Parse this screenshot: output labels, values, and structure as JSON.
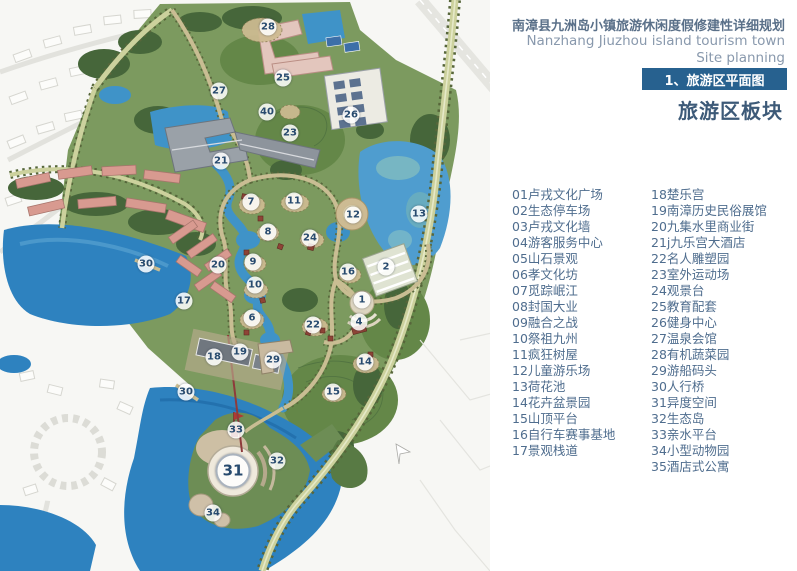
{
  "header": {
    "title_cn": "南漳县九洲岛小镇旅游休闲度假修建性详细规划",
    "title_en_line1": "Nanzhang Jiuzhou island tourism town",
    "title_en_line2": "Site planning",
    "section_banner": "1、旅游区平面图",
    "section_subtitle": "旅游区板块"
  },
  "legend": {
    "col1": [
      {
        "num": "01",
        "label": "卢戎文化广场"
      },
      {
        "num": "02",
        "label": "生态停车场"
      },
      {
        "num": "03",
        "label": "卢戎文化墙"
      },
      {
        "num": "04",
        "label": "游客服务中心"
      },
      {
        "num": "05",
        "label": "山石景观"
      },
      {
        "num": "06",
        "label": "孝文化坊"
      },
      {
        "num": "07",
        "label": "觅踪岷江"
      },
      {
        "num": "08",
        "label": "封国大业"
      },
      {
        "num": "09",
        "label": "融合之战"
      },
      {
        "num": "10",
        "label": "祭祖九州"
      },
      {
        "num": "11",
        "label": "疯狂树屋"
      },
      {
        "num": "12",
        "label": "儿童游乐场"
      },
      {
        "num": "13",
        "label": "荷花池"
      },
      {
        "num": "14",
        "label": "花卉盆景园"
      },
      {
        "num": "15",
        "label": "山顶平台"
      },
      {
        "num": "16",
        "label": "自行车赛事基地"
      },
      {
        "num": "17",
        "label": "景观栈道"
      }
    ],
    "col2": [
      {
        "num": "18",
        "label": "楚乐宫"
      },
      {
        "num": "19",
        "label": "南漳历史民俗展馆"
      },
      {
        "num": "20",
        "label": "九集水里商业街"
      },
      {
        "num": "21",
        "label": "j九乐宫大酒店"
      },
      {
        "num": "22",
        "label": "名人雕塑园"
      },
      {
        "num": "23",
        "label": "室外运动场"
      },
      {
        "num": "24",
        "label": "观景台"
      },
      {
        "num": "25",
        "label": "教育配套"
      },
      {
        "num": "26",
        "label": "健身中心"
      },
      {
        "num": "27",
        "label": "温泉会馆"
      },
      {
        "num": "28",
        "label": "有机蔬菜园"
      },
      {
        "num": "29",
        "label": "游船码头"
      },
      {
        "num": "30",
        "label": "人行桥"
      },
      {
        "num": "31",
        "label": "异度空间"
      },
      {
        "num": "32",
        "label": "生态岛"
      },
      {
        "num": "33",
        "label": "亲水平台"
      },
      {
        "num": "34",
        "label": "小型动物园"
      },
      {
        "num": "35",
        "label": "酒店式公寓"
      }
    ]
  },
  "map": {
    "markers": [
      {
        "n": "28",
        "x": 268,
        "y": 27
      },
      {
        "n": "25",
        "x": 283,
        "y": 78
      },
      {
        "n": "27",
        "x": 219,
        "y": 91
      },
      {
        "n": "40",
        "x": 267,
        "y": 112
      },
      {
        "n": "26",
        "x": 351,
        "y": 115
      },
      {
        "n": "23",
        "x": 290,
        "y": 133
      },
      {
        "n": "21",
        "x": 221,
        "y": 161
      },
      {
        "n": "7",
        "x": 251,
        "y": 202
      },
      {
        "n": "11",
        "x": 294,
        "y": 201
      },
      {
        "n": "12",
        "x": 353,
        "y": 215
      },
      {
        "n": "13",
        "x": 419,
        "y": 214
      },
      {
        "n": "8",
        "x": 268,
        "y": 232
      },
      {
        "n": "24",
        "x": 310,
        "y": 238
      },
      {
        "n": "9",
        "x": 253,
        "y": 262
      },
      {
        "n": "20",
        "x": 218,
        "y": 265
      },
      {
        "n": "30",
        "x": 146,
        "y": 264
      },
      {
        "n": "2",
        "x": 386,
        "y": 267
      },
      {
        "n": "16",
        "x": 348,
        "y": 272
      },
      {
        "n": "10",
        "x": 255,
        "y": 285
      },
      {
        "n": "17",
        "x": 184,
        "y": 301
      },
      {
        "n": "1",
        "x": 362,
        "y": 300
      },
      {
        "n": "6",
        "x": 252,
        "y": 318
      },
      {
        "n": "4",
        "x": 359,
        "y": 322
      },
      {
        "n": "22",
        "x": 313,
        "y": 325
      },
      {
        "n": "19",
        "x": 240,
        "y": 352
      },
      {
        "n": "18",
        "x": 214,
        "y": 357
      },
      {
        "n": "29",
        "x": 273,
        "y": 360
      },
      {
        "n": "14",
        "x": 365,
        "y": 362
      },
      {
        "n": "15",
        "x": 333,
        "y": 392
      },
      {
        "n": "30",
        "x": 186,
        "y": 392
      },
      {
        "n": "33",
        "x": 236,
        "y": 430
      },
      {
        "n": "32",
        "x": 277,
        "y": 461
      },
      {
        "n": "31",
        "x": 233,
        "y": 471,
        "big": true
      },
      {
        "n": "34",
        "x": 213,
        "y": 513
      }
    ]
  },
  "colors": {
    "banner_blue": "#27618f",
    "title_blue": "#5a7089",
    "legend_blue": "#4f6d8e",
    "water": "#2e82bf",
    "site_green": "#7c9a5f"
  }
}
